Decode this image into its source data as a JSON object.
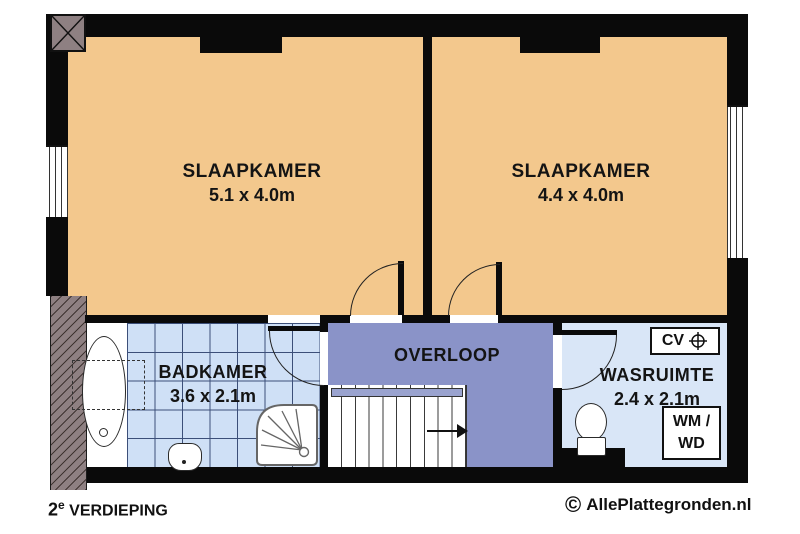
{
  "page": {
    "background": "#ffffff",
    "type": "floor-plan"
  },
  "colors": {
    "wall": "#0a0a0a",
    "bedroom_fill": "#f3c88d",
    "landing_fill": "#8a93c8",
    "bathroom_tile_fill": "#cfe0f6",
    "bathroom_tile_line": "#3c4f79",
    "laundry_fill": "#d9e6f7",
    "sloped_wall_hatch": "#8e8082"
  },
  "rooms": {
    "bedroom_left": {
      "name": "SLAAPKAMER",
      "dimensions": "5.1 x 4.0m"
    },
    "bedroom_right": {
      "name": "SLAAPKAMER",
      "dimensions": "4.4 x 4.0m"
    },
    "bathroom": {
      "name": "BADKAMER",
      "dimensions": "3.6 x 2.1m"
    },
    "landing": {
      "name": "OVERLOOP"
    },
    "laundry": {
      "name": "WASRUIMTE",
      "dimensions": "2.4 x 2.1m"
    }
  },
  "equipment": {
    "cv_label": "CV",
    "wm_wd_line1": "WM /",
    "wm_wd_line2": "WD"
  },
  "footer": {
    "floor_number": "2",
    "floor_suffix": "e",
    "floor_text": "VERDIEPING",
    "copyright_symbol": "©",
    "watermark_text": "AllePlattegronden.nl"
  }
}
